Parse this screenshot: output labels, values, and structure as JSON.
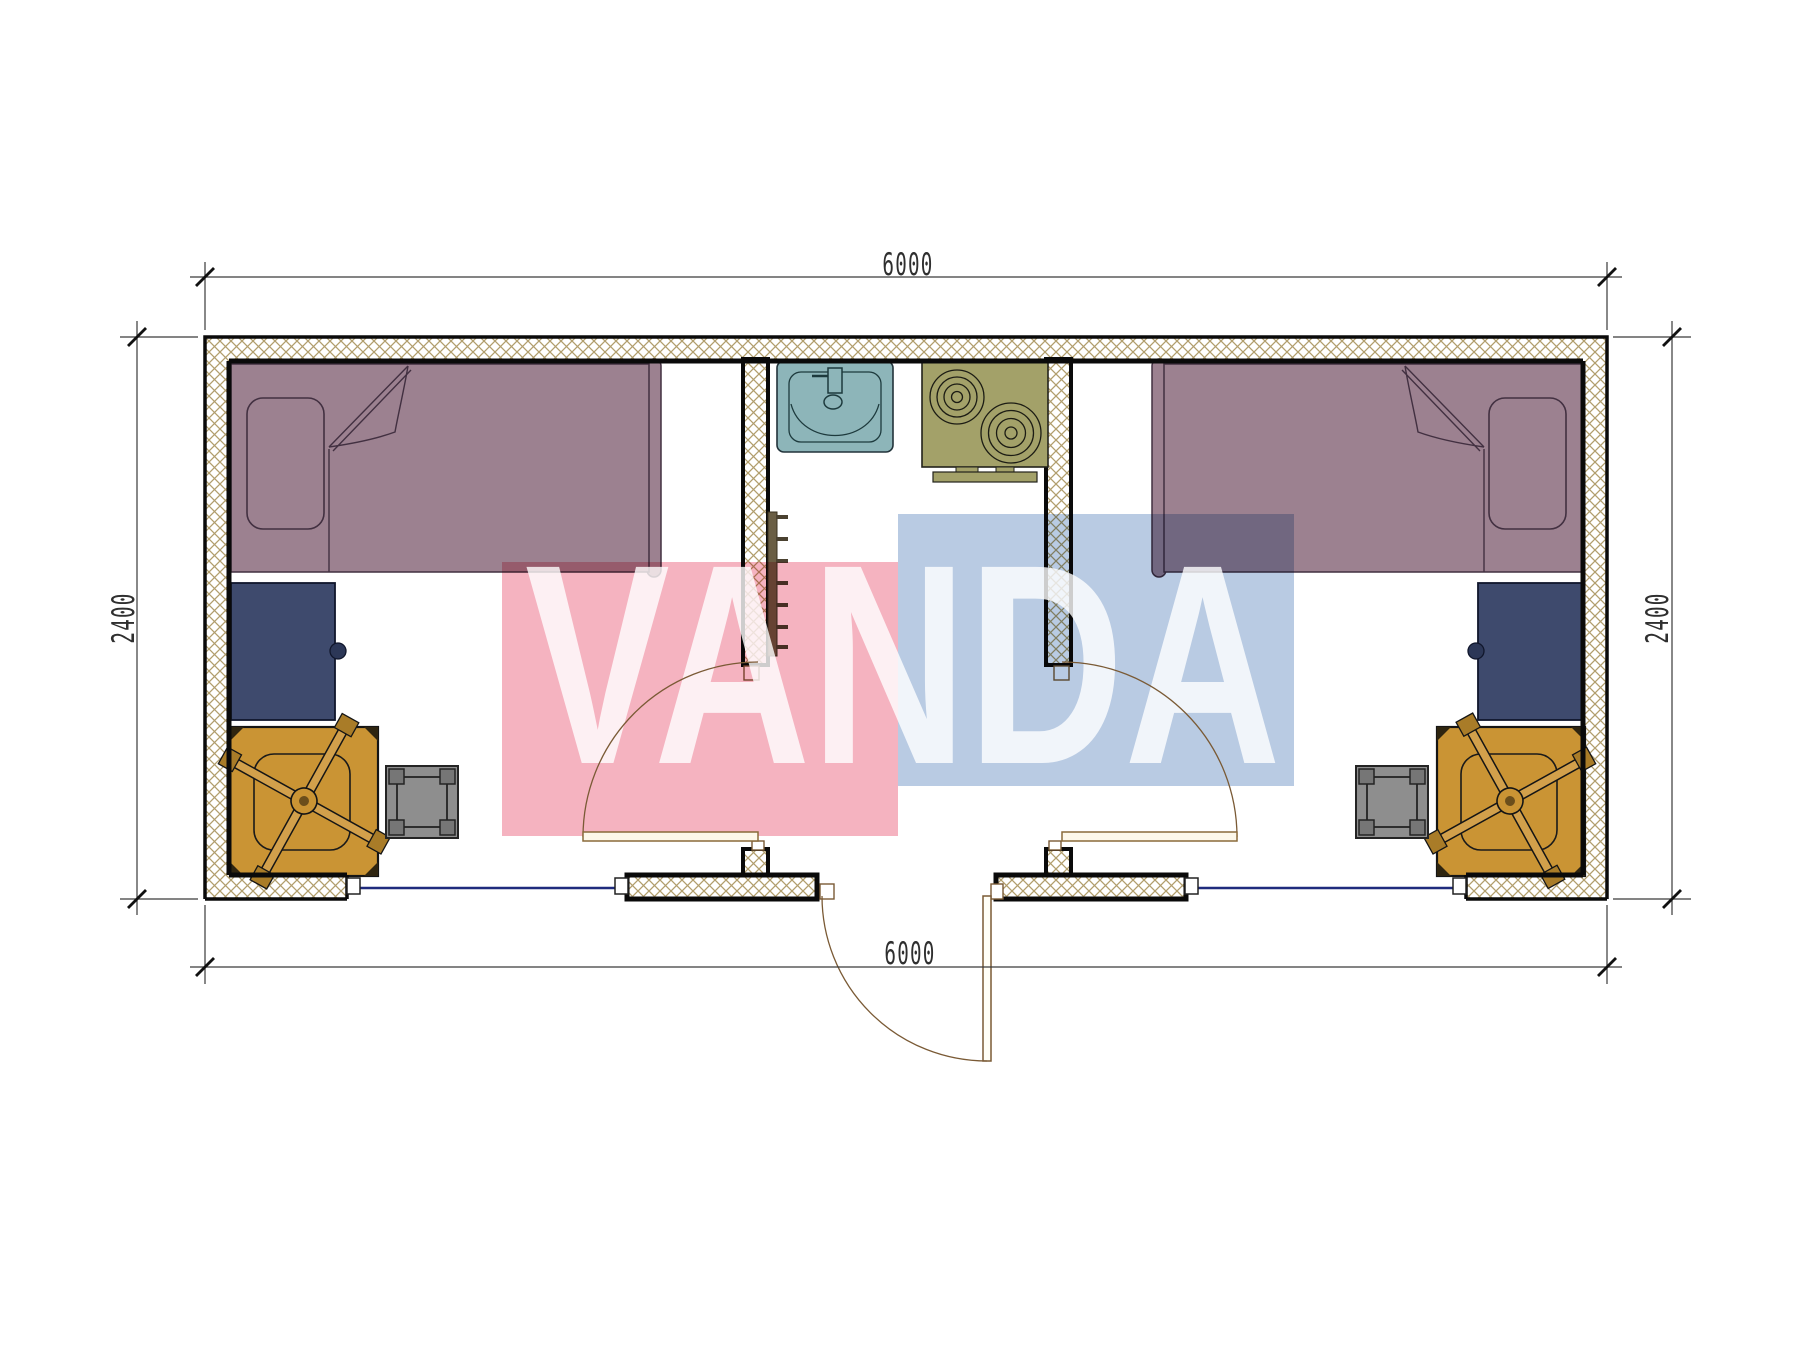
{
  "drawing": {
    "dimensions": {
      "top": "6000",
      "bottom": "6000",
      "left": "2400",
      "right": "2400"
    },
    "watermark": {
      "text": "VANDA",
      "pink": "#f5b3c0",
      "blue": "#b9cbe3"
    },
    "palette": {
      "wall_hatch": "#b19e6d",
      "wall_line": "#0a0a0a",
      "bed_fill": "#9c8190",
      "bed_outline": "#423041",
      "desk_fill": "#3e4a6d",
      "chair_fill": "#ca9434",
      "stool_fill": "#8e8e8e",
      "sink_fill": "#8db5b9",
      "stove_fill": "#a3a169",
      "door_line": "#7a5a35",
      "window_line": "#1f2b7d",
      "dim_text": "#2f2f2f"
    },
    "elements": {
      "left_room": [
        "bed",
        "desk",
        "office-chair",
        "stool",
        "window",
        "swing-door"
      ],
      "core": [
        "sink",
        "stove",
        "towel-ladder",
        "entry-door"
      ],
      "right_room": [
        "bed",
        "desk",
        "office-chair",
        "stool",
        "window",
        "swing-door"
      ]
    }
  }
}
